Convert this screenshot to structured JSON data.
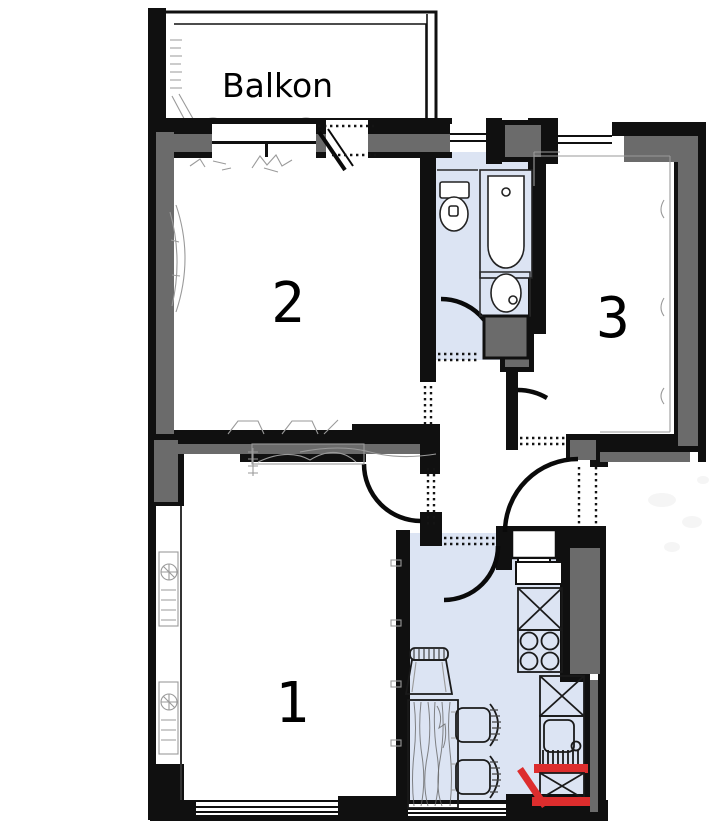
{
  "labels": {
    "balcony": "Balkon",
    "room_1": "1",
    "room_2": "2",
    "room_3": "3"
  },
  "colors": {
    "wall_black": "#101010",
    "wall_gray": "#6b6b6b",
    "floor_tint": "#dce4f3",
    "highlight_red": "#dd2d2d",
    "sketch": "#9a9a9a",
    "line": "#2a2a2a",
    "background": "#ffffff"
  },
  "icons": [
    "toilet-icon",
    "bathtub-icon",
    "washbasin-icon",
    "kitchen-sink-icon",
    "stove-icon",
    "cabinet-icon",
    "dining-table-icon",
    "chair-icon",
    "radiator-icon",
    "door-swing-icon",
    "window-icon",
    "red-highlight-marks"
  ]
}
